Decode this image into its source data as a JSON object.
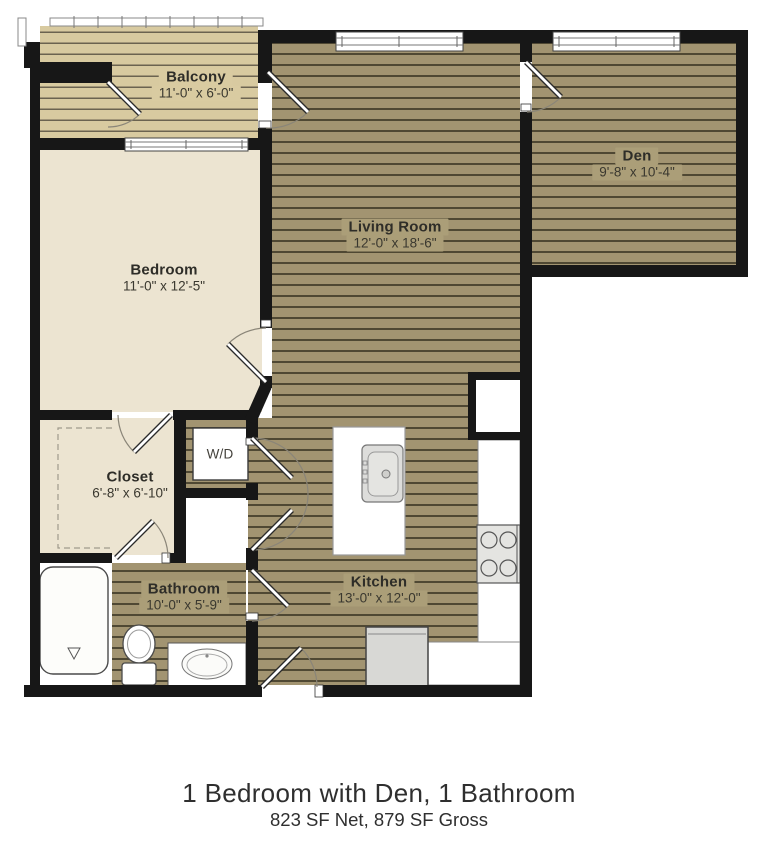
{
  "plan": {
    "rooms": [
      {
        "name": "Balcony",
        "dims": "11'-0\" x 6'-0\""
      },
      {
        "name": "Den",
        "dims": "9'-8\" x 10'-4\""
      },
      {
        "name": "Living Room",
        "dims": "12'-0\" x 18'-6\""
      },
      {
        "name": "Bedroom",
        "dims": "11'-0\" x 12'-5\""
      },
      {
        "name": "Closet",
        "dims": "6'-8\" x 6'-10\""
      },
      {
        "name": "W/D",
        "dims": ""
      },
      {
        "name": "Bathroom",
        "dims": "10'-0\" x 5'-9\""
      },
      {
        "name": "Kitchen",
        "dims": "13'-0\" x 12'-0\""
      }
    ],
    "fixtures": [
      "bathtub",
      "toilet",
      "sink-vanity",
      "kitchen-island",
      "kitchen-island-sink",
      "stove",
      "refrigerator",
      "washer-dryer",
      "closet-shelving",
      "balcony-railing",
      "pantry-niche"
    ],
    "colors": {
      "wood_floor": "#a29471",
      "plank_line": "#4f4833",
      "deck_floor": "#d8caa0",
      "room_cream": "#ece4d1",
      "wall": "#171717"
    }
  },
  "caption": {
    "title": "1 Bedroom with Den, 1 Bathroom",
    "subtitle": "823 SF Net, 879 SF Gross"
  }
}
